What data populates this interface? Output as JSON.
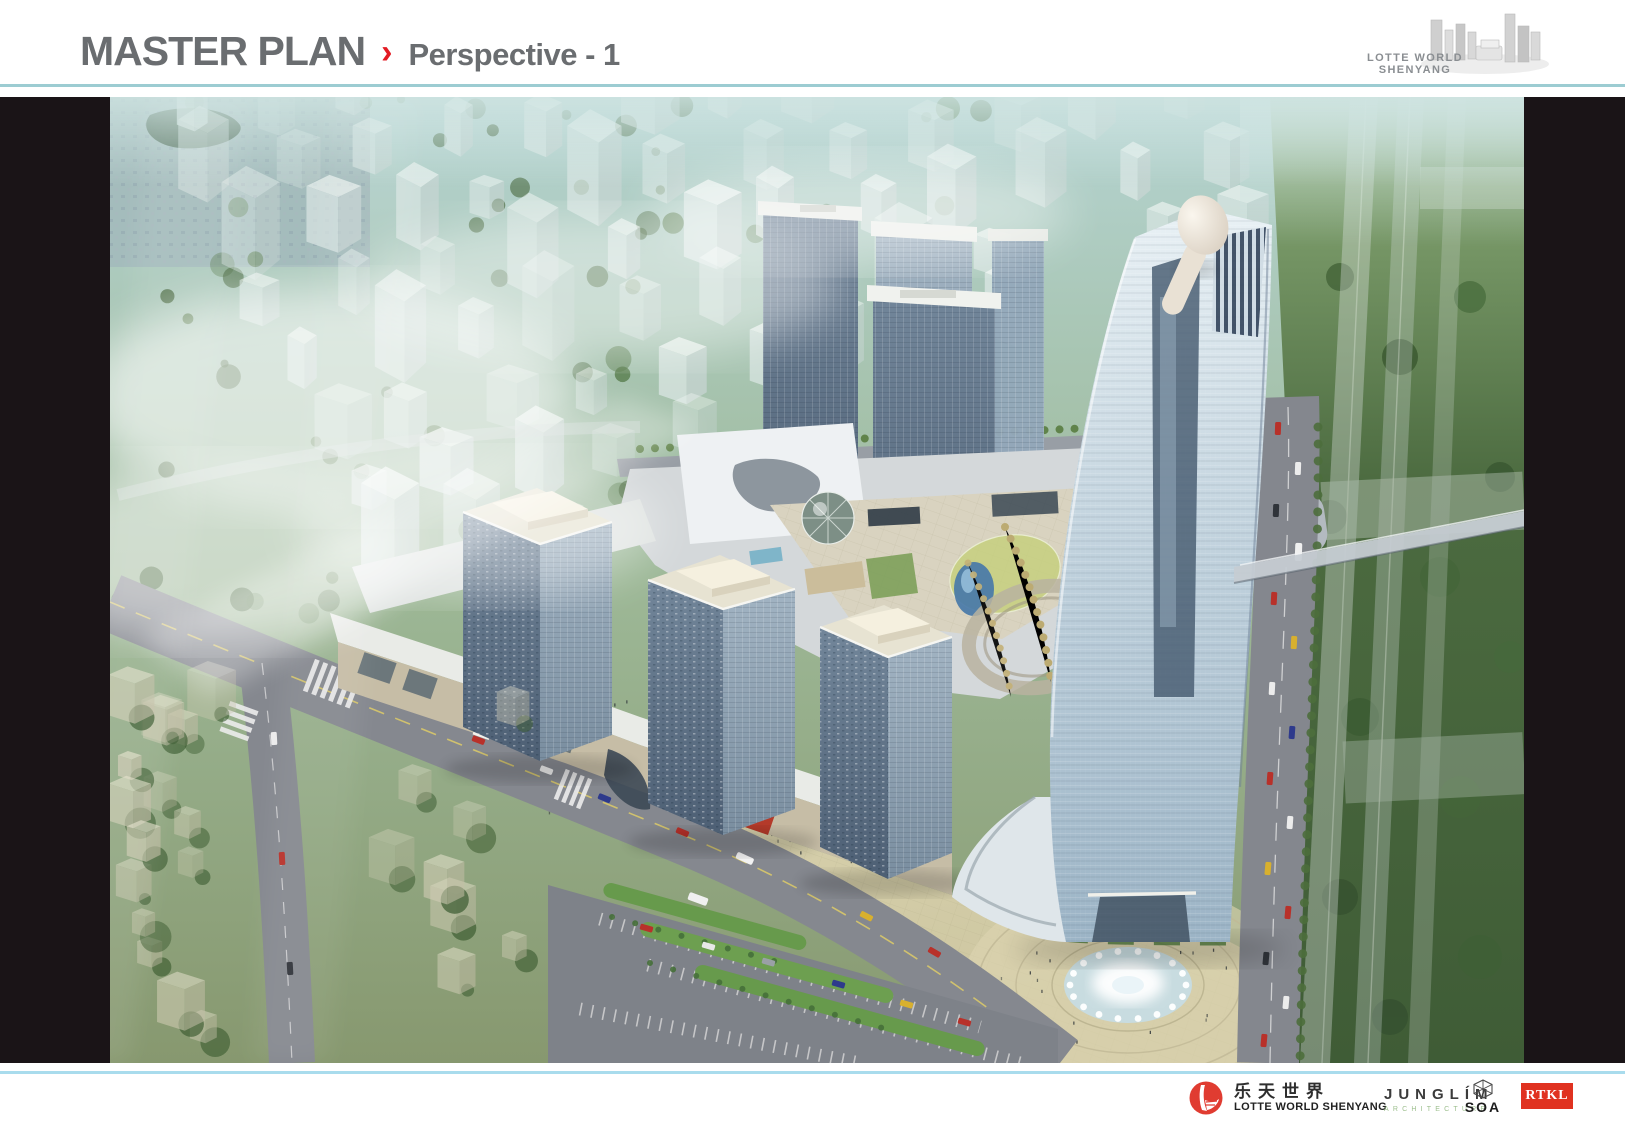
{
  "header": {
    "title": "MASTER PLAN",
    "divider_glyph": "›",
    "subtitle": "Perspective - 1",
    "logo_caption": "LOTTE WORLD SHENYANG"
  },
  "colors": {
    "accent_red": "#e31b23",
    "title_gray": "#6a6d70",
    "rule_top_teal": "#9cccd2",
    "rule_bottom_blue": "#a9dced",
    "panel_black": "#1a1417",
    "lotte_brand_red": "#e03c31",
    "rtkl_red": "#e03220",
    "junglim_green": "#9dbf8e"
  },
  "footer": {
    "lotte_cn": "乐天世界",
    "lotte_en": "LOTTE WORLD SHENYANG",
    "junglim_name": "JUNGLÍM",
    "junglim_sub": "ARCHITECTURE",
    "soa_name": "SOA",
    "rtkl_name": "RTKL"
  }
}
